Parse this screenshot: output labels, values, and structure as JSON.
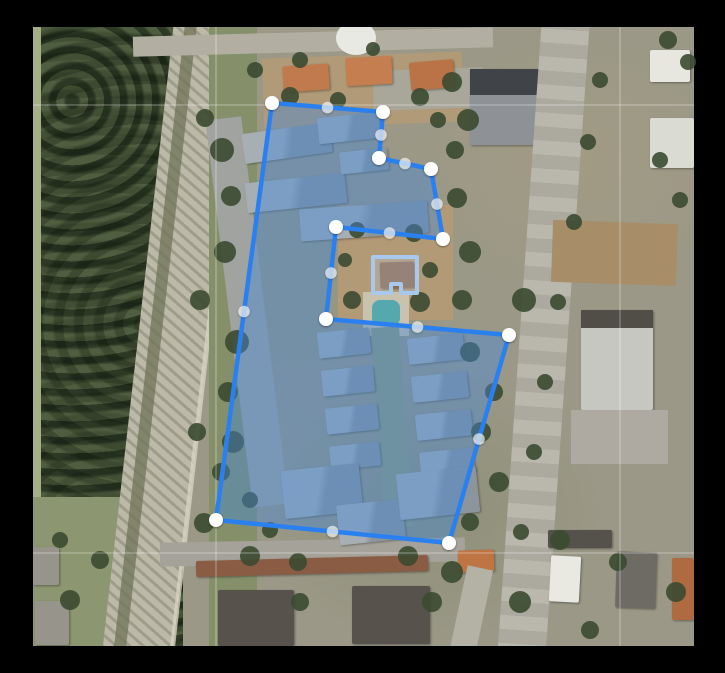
{
  "window": {
    "frame_color": "#000000"
  },
  "map": {
    "kind": "satellite-imagery",
    "area": {
      "left": 33,
      "top": 27,
      "width": 661,
      "height": 619
    },
    "grid": {
      "vertical_x": [
        216,
        620
      ],
      "horizontal_y": [
        105,
        553
      ],
      "color": "rgba(255,255,255,0.4)"
    },
    "parcel_polygon": {
      "stroke_color": "#2b80f0",
      "stroke_width": 4.5,
      "fill_color": "rgba(66,136,218,0.42)",
      "vertices": [
        [
          272,
          103
        ],
        [
          383,
          112
        ],
        [
          379,
          158
        ],
        [
          431,
          169
        ],
        [
          443,
          239
        ],
        [
          336,
          227
        ],
        [
          326,
          319
        ],
        [
          509,
          335
        ],
        [
          449,
          543
        ],
        [
          216,
          520
        ]
      ],
      "vertex_handle": {
        "color": "#ffffff",
        "radius": 7
      },
      "midpoint_handle": {
        "color": "rgba(255,255,255,0.62)",
        "radius": 5.8
      }
    },
    "building_outline_polygon": {
      "stroke_color": "#a9c8ee",
      "stroke_width": 4,
      "fill_color": "rgba(186,208,234,0.25)",
      "vertices": [
        [
          373,
          257
        ],
        [
          417,
          257
        ],
        [
          417,
          293
        ],
        [
          401,
          293
        ],
        [
          401,
          284
        ],
        [
          391,
          284
        ],
        [
          391,
          293
        ],
        [
          373,
          293
        ]
      ]
    }
  }
}
